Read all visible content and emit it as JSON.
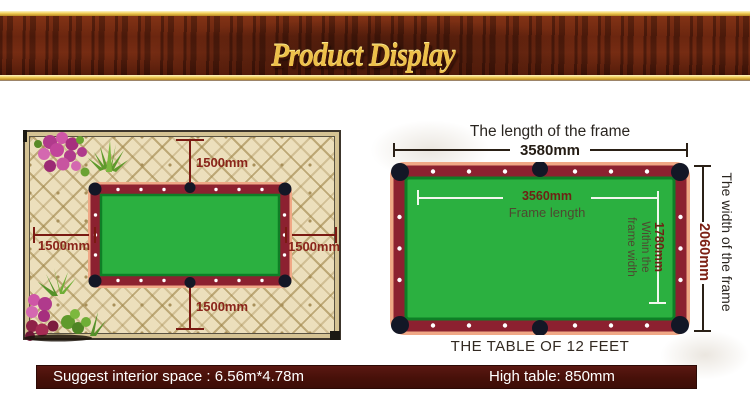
{
  "banner": {
    "title": "Product Display"
  },
  "room_diagram": {
    "clearance_top": "1500mm",
    "clearance_left": "1500mm",
    "clearance_right": "1500mm",
    "clearance_bottom": "1500mm"
  },
  "table_diagram": {
    "top_title": "The length of the frame",
    "outer_length": "3580mm",
    "inner_length": "3560mm",
    "inner_length_caption": "Frame length",
    "inner_width": "1780mm",
    "inner_width_caption_line1": "Within the",
    "inner_width_caption_line2": "frame width",
    "outer_width": "2060mm",
    "side_title": "The width of the frame",
    "caption": "THE TABLE OF 12 FEET"
  },
  "footer": {
    "left_text": "Suggest interior space : 6.56m*4.78m",
    "right_text": "High table: 850mm"
  },
  "colors": {
    "accent_gold": "#edc04a",
    "wood_brown": "#61210d",
    "table_green": "#2bb040",
    "rail_maroon": "#8c2130",
    "pocket_dark": "#131726",
    "corner_salmon": "#f0a886",
    "dimension_red": "#8a241a",
    "footer_maroon": "#471009"
  }
}
